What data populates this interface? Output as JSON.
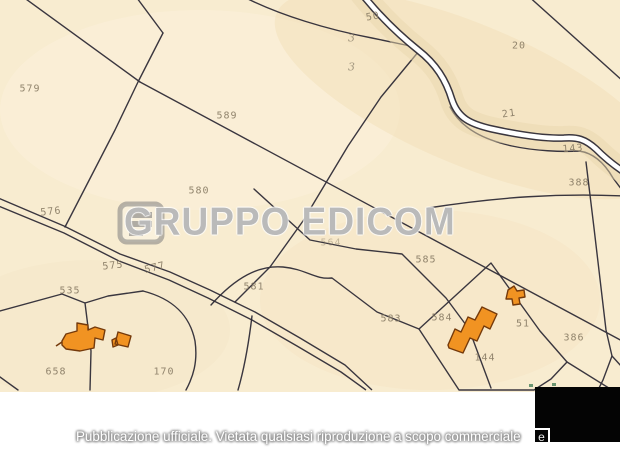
{
  "watermark": {
    "brand": "GRUPPO EDICOM",
    "logo": "edicom-logo"
  },
  "footer": {
    "caption": "Pubblicazione ufficiale. Vietata qualsiasi riproduzione a scopo commerciale",
    "boxed_char": "e"
  },
  "map": {
    "parcel_labels": [
      {
        "text": "579",
        "x": 30,
        "y": 89
      },
      {
        "text": "589",
        "x": 227,
        "y": 116
      },
      {
        "text": "580",
        "x": 199,
        "y": 191
      },
      {
        "text": "576",
        "x": 51,
        "y": 212,
        "r": -6
      },
      {
        "text": "50",
        "x": 373,
        "y": 17,
        "r": -10
      },
      {
        "text": "20",
        "x": 519,
        "y": 46
      },
      {
        "text": "21",
        "x": 509,
        "y": 114,
        "r": -8
      },
      {
        "text": "143",
        "x": 573,
        "y": 149,
        "r": -4
      },
      {
        "text": "388",
        "x": 579,
        "y": 183
      },
      {
        "text": "564",
        "x": 331,
        "y": 243,
        "o": 0.5
      },
      {
        "text": "575",
        "x": 113,
        "y": 266,
        "r": -6
      },
      {
        "text": "577",
        "x": 155,
        "y": 268,
        "r": -14
      },
      {
        "text": "535",
        "x": 70,
        "y": 291
      },
      {
        "text": "581",
        "x": 254,
        "y": 287
      },
      {
        "text": "583",
        "x": 391,
        "y": 319
      },
      {
        "text": "585",
        "x": 426,
        "y": 260
      },
      {
        "text": "584",
        "x": 442,
        "y": 318
      },
      {
        "text": "51",
        "x": 523,
        "y": 324
      },
      {
        "text": "386",
        "x": 574,
        "y": 338
      },
      {
        "text": "144",
        "x": 485,
        "y": 358
      },
      {
        "text": "658",
        "x": 56,
        "y": 372
      },
      {
        "text": "170",
        "x": 164,
        "y": 372
      },
      {
        "text": "3",
        "x": 352,
        "y": 38,
        "sym": true
      },
      {
        "text": "3",
        "x": 352,
        "y": 67,
        "sym": true
      }
    ],
    "colors": {
      "paper": "#f8ecd0",
      "line": "#2a2733",
      "label": "#8b7e67",
      "building_fill": "#f19322",
      "building_stroke": "#753a0b",
      "stream_fill": "#ffffff"
    }
  }
}
